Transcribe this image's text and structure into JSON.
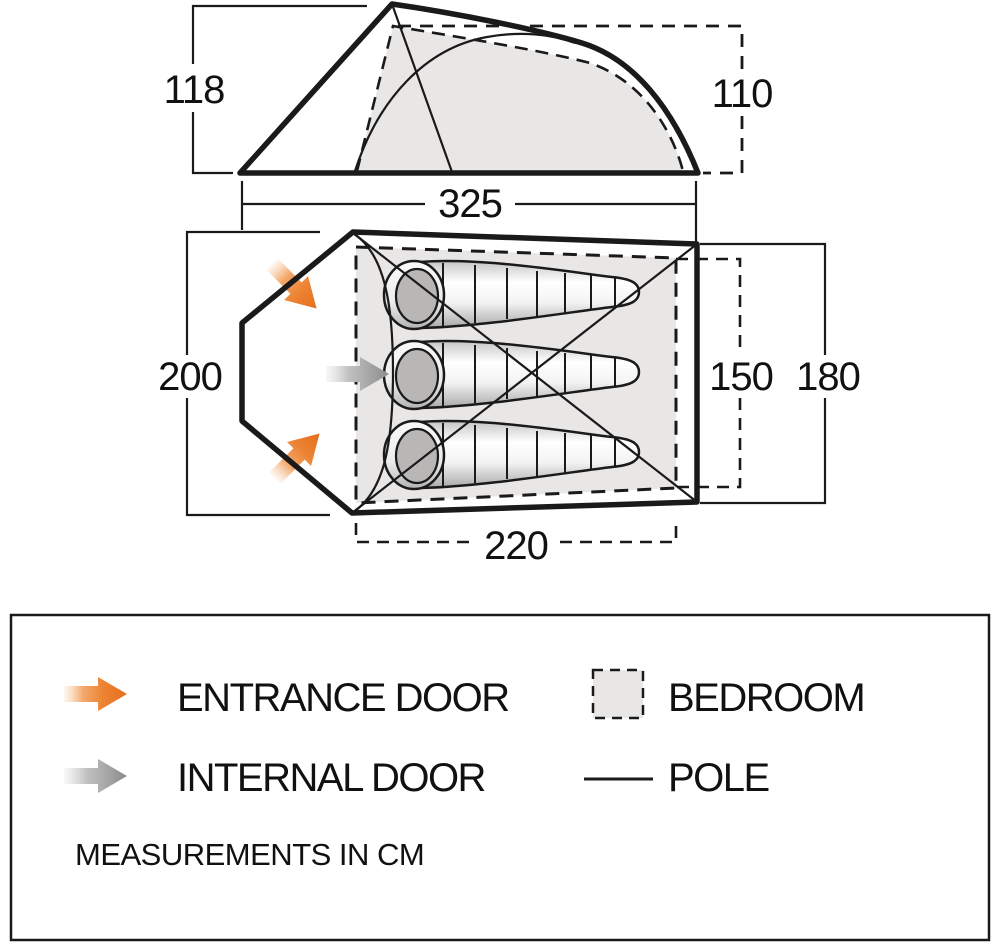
{
  "dimensions": {
    "side_height_front": "118",
    "side_height_rear": "110",
    "side_width": "325",
    "plan_length": "200",
    "plan_inner_width": "220",
    "plan_inner_depth": "150",
    "plan_outer_depth": "180"
  },
  "legend": {
    "entrance_door": "ENTRANCE DOOR",
    "internal_door": "INTERNAL DOOR",
    "bedroom": "BEDROOM",
    "pole": "POLE",
    "note": "MEASUREMENTS IN CM"
  },
  "icons": {
    "entrance_arrow": "orange-gradient-arrow",
    "internal_arrow": "gray-gradient-arrow",
    "bedroom_swatch": "dashed-gray-square",
    "pole_swatch": "thin-black-line"
  },
  "colors": {
    "entrance_arrow": "#E56F1E",
    "internal_arrow": "#8C8C8C",
    "bedroom_fill": "#E9E6E6",
    "outline": "#1A1A1A"
  }
}
